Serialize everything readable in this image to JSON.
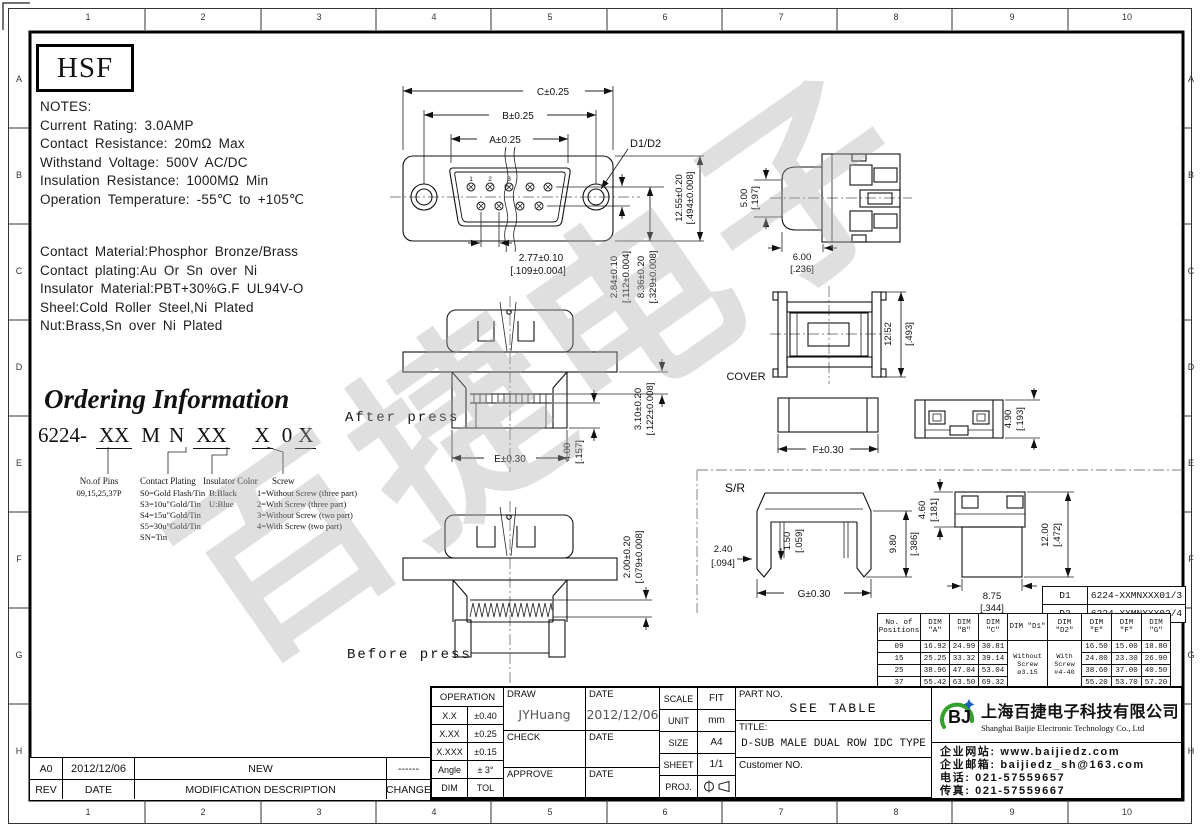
{
  "logo": "HSF",
  "watermark": "百捷电子",
  "notes": {
    "title": "NOTES:",
    "lines": [
      "Current Rating: 3.0AMP",
      "Contact Resistance: 20mΩ Max",
      "Withstand Voltage: 500V AC/DC",
      "Insulation Resistance: 1000MΩ Min",
      "Operation Temperature: -55℃ to +105℃"
    ],
    "materials": [
      "Contact Material:Phosphor Bronze/Brass",
      "Contact plating:Au Or Sn over Ni",
      "Insulator Material:PBT+30%G.F UL94V-O",
      "Sheel:Cold Roller Steel,Ni Plated",
      "Nut:Brass,Sn over Ni Plated"
    ]
  },
  "ordering": {
    "heading": "Ordering Information",
    "prefix": "6224-",
    "seg1": "XX",
    "seg2": "M",
    "seg3": "N",
    "seg4": "XX",
    "seg5": "X",
    "seg6": "0",
    "seg7": "X",
    "groups": [
      {
        "title": "No.of Pins",
        "lines": [
          "09,15,25,37P"
        ]
      },
      {
        "title": "Contact Plating",
        "lines": [
          "S0=Gold Flash/Tin",
          "S3=10u\"Gold/Tin",
          "S4=15u\"Gold/Tin",
          "S5=30u\"Gold/Tin",
          "SN=Tin"
        ]
      },
      {
        "title": "Insulator Color",
        "lines": [
          "B:Black",
          "U:Blue"
        ]
      },
      {
        "title": "Screw",
        "lines": [
          "1=Without Screw (three part)",
          "2=With Screw (three part)",
          "3=Without Screw (two part)",
          "4=With Screw (two part)"
        ]
      }
    ]
  },
  "views": {
    "after": "After press",
    "before": "Before press",
    "cover": "COVER",
    "sr": "S/R"
  },
  "dims": {
    "c": "C±0.25",
    "b": "B±0.25",
    "a": "A±0.25",
    "d": "D1/D2",
    "fh_mm": "12.55±0.20",
    "fh_in": "[.494±0.008]",
    "pitch_mm": "2.77±0.10",
    "pitch_in": "[.109±0.004]",
    "row_mm": "2.84±0.10",
    "row_in": "[.112±0.004]",
    "tail_mm": "8.36±0.20",
    "tail_in": "[.329±0.008]",
    "sh_mm": "5.00",
    "sh_in": "[.197]",
    "sw_mm": "6.00",
    "sw_in": "[.236]",
    "ch_mm": "12.52",
    "ch_in": "[.493]",
    "f": "F±0.30",
    "lh_mm": "4.90",
    "lh_in": "[.193]",
    "e": "E±0.30",
    "ph_mm": "4.00",
    "ph_in": "[.157]",
    "pd_mm": "3.10±0.20",
    "pd_in": "[.122±0.008]",
    "bh_mm": "2.00±0.20",
    "bh_in": "[.079±0.008]",
    "srw_mm": "2.40",
    "srw_in": "[.094]",
    "srs_mm": "1.50",
    "srs_in": "[.059]",
    "srh_mm": "9.80",
    "srh_in": "[.386]",
    "g": "G±0.30",
    "st_mm": "4.60",
    "st_in": "[.181]",
    "sv_mm": "12.00",
    "sv_in": "[.472]",
    "sb_mm": "8.75",
    "sb_in": "[.344]",
    "pins": [
      "1",
      "2",
      "3"
    ]
  },
  "part_table": {
    "d1_key": "D1",
    "d1_value": "6224-XXMNXXX01/3",
    "d2_key": "D2",
    "d2_value": "6224-XXMNXXX02/4"
  },
  "dim_table": {
    "h_pos_1": "No. of",
    "h_pos_2": "Positions",
    "h_a": "DIM \"A\"",
    "h_b": "DIM \"B\"",
    "h_c": "DIM \"C\"",
    "h_d1": "DIM \"D1\"",
    "h_d2": "DIM \"D2\"",
    "h_e": "DIM \"E\"",
    "h_f": "DIM \"F\"",
    "h_g": "DIM \"G\"",
    "d1_1": "Without Screw",
    "d1_2": "ø3.15",
    "d2_1": "With Screw",
    "d2_2": "#4-40",
    "rows": [
      [
        "09",
        "16.92",
        "24.99",
        "30.81",
        "16.50",
        "15.00",
        "18.80"
      ],
      [
        "15",
        "25.25",
        "33.32",
        "39.14",
        "24.80",
        "23.30",
        "26.90"
      ],
      [
        "25",
        "38.96",
        "47.04",
        "53.04",
        "38.60",
        "37.00",
        "40.50"
      ],
      [
        "37",
        "55.42",
        "63.50",
        "69.32",
        "55.20",
        "53.70",
        "57.20"
      ]
    ]
  },
  "title_block": {
    "operation": "OPERATION",
    "tol_rows": [
      [
        "X.X",
        "±0.40"
      ],
      [
        "X.XX",
        "±0.25"
      ],
      [
        "X.XXX",
        "±0.15"
      ],
      [
        "Angle",
        "± 3°"
      ],
      [
        "DIM",
        "TOL"
      ]
    ],
    "draw": "DRAW",
    "draw_name": "JYHuang",
    "date": "DATE",
    "draw_date": "2012/12/06",
    "check": "CHECK",
    "approve": "APPROVE",
    "scale": "SCALE",
    "scale_v": "FIT",
    "unit": "UNIT",
    "unit_v": "mm",
    "size": "SIZE",
    "size_v": "A4",
    "sheet": "SHEET",
    "sheet_v": "1/1",
    "proj": "PROJ.",
    "part_no": "PART NO.",
    "part_no_v": "SEE TABLE",
    "title": "TITLE:",
    "title_v": "D-SUB MALE DUAL ROW IDC TYPE",
    "customer": "Customer NO."
  },
  "company": {
    "logo_text": "BJ",
    "name_cn": "上海百捷电子科技有限公司",
    "name_en": "Shanghai Baijie Electronic Technology Co., Ltd",
    "lines": [
      "企业网站: www.baijiedz.com",
      "企业邮箱: baijiedz_sh@163.com",
      "电话: 021-57559657",
      "传真: 021-57559667"
    ]
  },
  "revision": {
    "rev": "A0",
    "date": "2012/12/06",
    "desc": "NEW",
    "change": "------",
    "h_rev": "REV",
    "h_date": "DATE",
    "h_desc": "MODIFICATION  DESCRIPTION",
    "h_change": "CHANGE"
  },
  "ruler": {
    "cols": [
      "1",
      "2",
      "3",
      "4",
      "5",
      "6",
      "7",
      "8",
      "9",
      "10"
    ],
    "rows": [
      "A",
      "B",
      "C",
      "D",
      "E",
      "F",
      "G",
      "H"
    ]
  }
}
